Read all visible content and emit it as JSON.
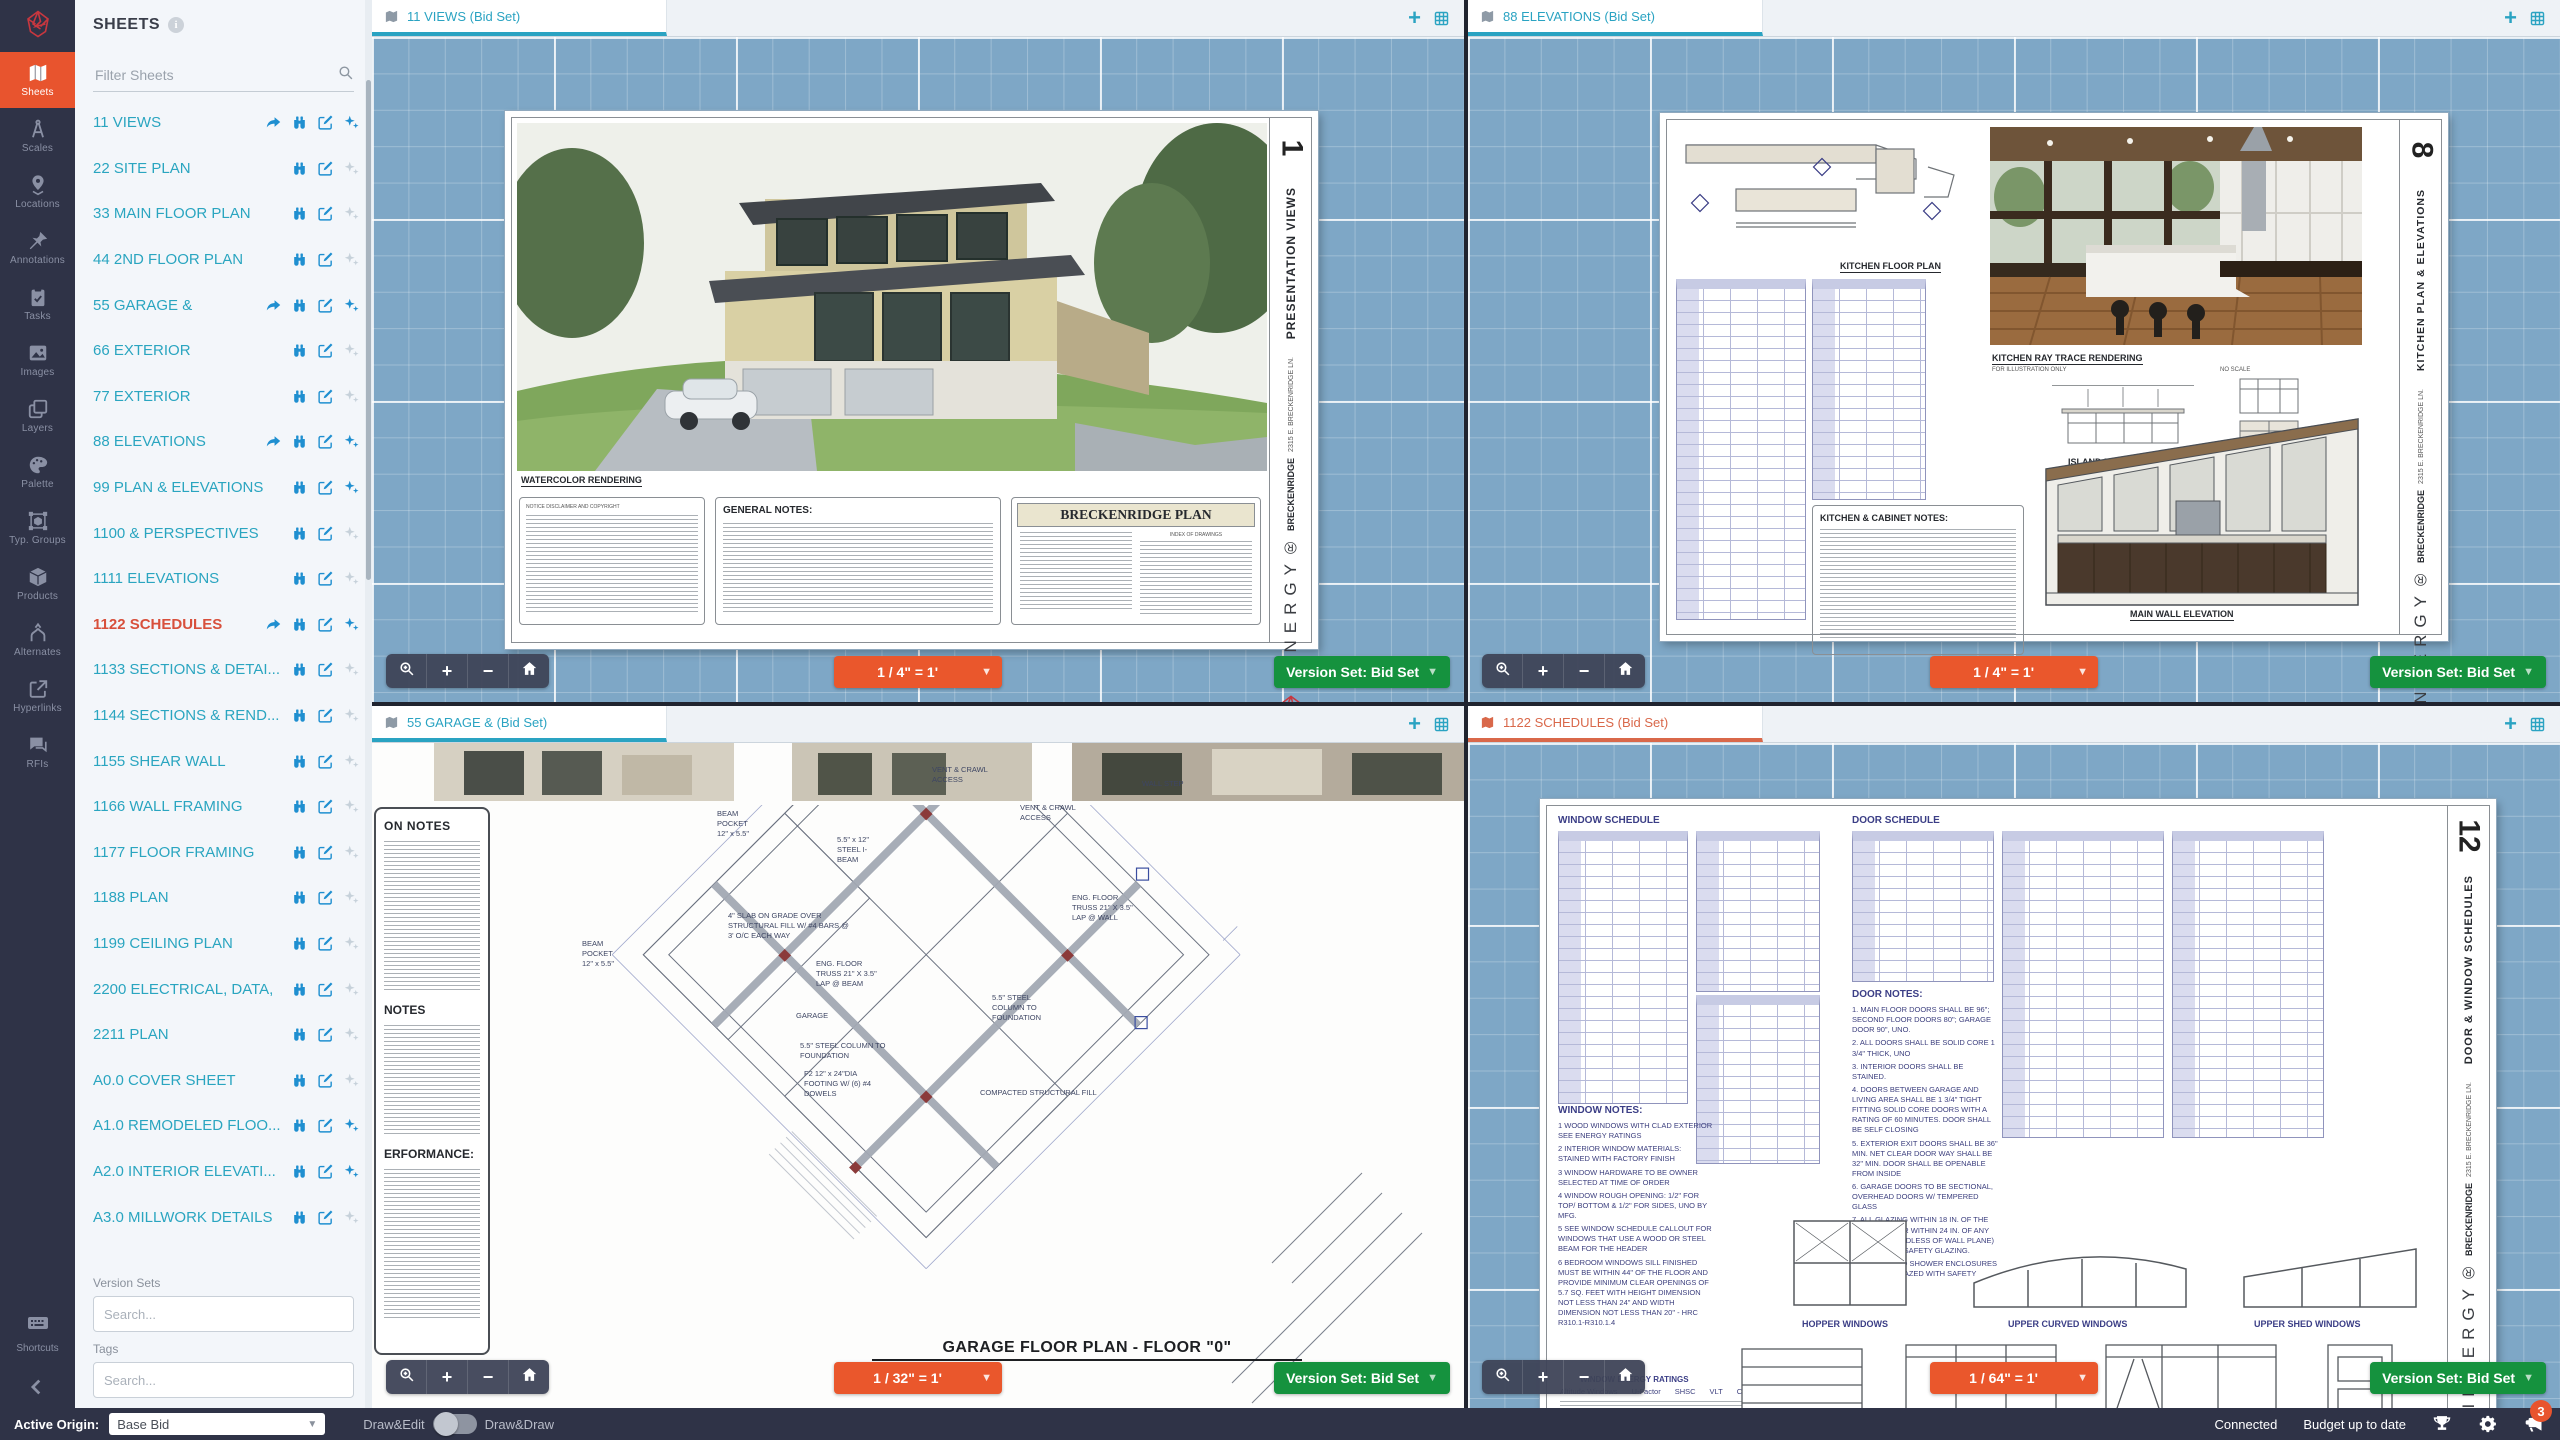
{
  "rail": {
    "items": [
      {
        "label": "Sheets",
        "icon": "map-icon",
        "active": true
      },
      {
        "label": "Scales",
        "icon": "compass-icon",
        "active": false
      },
      {
        "label": "Locations",
        "icon": "map-pin-icon",
        "active": false
      },
      {
        "label": "Annotations",
        "icon": "pushpin-icon",
        "active": false
      },
      {
        "label": "Tasks",
        "icon": "clipboard-icon",
        "active": false
      },
      {
        "label": "Images",
        "icon": "image-icon",
        "active": false
      },
      {
        "label": "Layers",
        "icon": "layers-icon",
        "active": false
      },
      {
        "label": "Palette",
        "icon": "palette-icon",
        "active": false
      },
      {
        "label": "Typ. Groups",
        "icon": "typ-groups-icon",
        "active": false
      },
      {
        "label": "Products",
        "icon": "products-icon",
        "active": false
      },
      {
        "label": "Alternates",
        "icon": "alternates-icon",
        "active": false
      },
      {
        "label": "Hyperlinks",
        "icon": "hyperlink-icon",
        "active": false
      },
      {
        "label": "RFIs",
        "icon": "rfi-icon",
        "active": false
      }
    ],
    "shortcuts_label": "Shortcuts"
  },
  "sheets_panel": {
    "title": "SHEETS",
    "filter_placeholder": "Filter Sheets",
    "items": [
      {
        "name": "11 VIEWS",
        "shared": true,
        "sparkle": true,
        "selected": false
      },
      {
        "name": "22 SITE PLAN",
        "shared": false,
        "sparkle": false,
        "selected": false
      },
      {
        "name": "33 MAIN FLOOR PLAN",
        "shared": false,
        "sparkle": false,
        "selected": false
      },
      {
        "name": "44 2ND FLOOR PLAN",
        "shared": false,
        "sparkle": false,
        "selected": false
      },
      {
        "name": "55 GARAGE &",
        "shared": true,
        "sparkle": true,
        "selected": false
      },
      {
        "name": "66 EXTERIOR",
        "shared": false,
        "sparkle": false,
        "selected": false
      },
      {
        "name": "77 EXTERIOR",
        "shared": false,
        "sparkle": false,
        "selected": false
      },
      {
        "name": "88 ELEVATIONS",
        "shared": true,
        "sparkle": true,
        "selected": false
      },
      {
        "name": "99 PLAN & ELEVATIONS",
        "shared": false,
        "sparkle": true,
        "selected": false
      },
      {
        "name": "1100 & PERSPECTIVES",
        "shared": false,
        "sparkle": false,
        "selected": false
      },
      {
        "name": "1111 ELEVATIONS",
        "shared": false,
        "sparkle": false,
        "selected": false
      },
      {
        "name": "1122 SCHEDULES",
        "shared": true,
        "sparkle": true,
        "selected": true
      },
      {
        "name": "1133 SECTIONS & DETAI...",
        "shared": false,
        "sparkle": false,
        "selected": false
      },
      {
        "name": "1144 SECTIONS & REND...",
        "shared": false,
        "sparkle": false,
        "selected": false
      },
      {
        "name": "1155 SHEAR WALL",
        "shared": false,
        "sparkle": false,
        "selected": false
      },
      {
        "name": "1166 WALL FRAMING",
        "shared": false,
        "sparkle": false,
        "selected": false
      },
      {
        "name": "1177 FLOOR FRAMING",
        "shared": false,
        "sparkle": false,
        "selected": false
      },
      {
        "name": "1188 PLAN",
        "shared": false,
        "sparkle": false,
        "selected": false
      },
      {
        "name": "1199 CEILING PLAN",
        "shared": false,
        "sparkle": false,
        "selected": false
      },
      {
        "name": "2200 ELECTRICAL, DATA,",
        "shared": false,
        "sparkle": false,
        "selected": false
      },
      {
        "name": "2211 PLAN",
        "shared": false,
        "sparkle": false,
        "selected": false
      },
      {
        "name": "A0.0 COVER SHEET",
        "shared": false,
        "sparkle": false,
        "selected": false
      },
      {
        "name": "A1.0 REMODELED FLOO...",
        "shared": false,
        "sparkle": true,
        "selected": false
      },
      {
        "name": "A2.0 INTERIOR ELEVATI...",
        "shared": false,
        "sparkle": true,
        "selected": false
      },
      {
        "name": "A3.0 MILLWORK DETAILS",
        "shared": false,
        "sparkle": false,
        "selected": false
      }
    ],
    "version_sets_label": "Version Sets",
    "version_sets_placeholder": "Search...",
    "tags_label": "Tags",
    "tags_placeholder": "Search..."
  },
  "viewports": [
    {
      "tab": "11 VIEWS (Bid Set)",
      "scale": "1 / 4\" = 1'",
      "version_set": "Version Set: Bid Set",
      "selected": false
    },
    {
      "tab": "88 ELEVATIONS (Bid Set)",
      "scale": "1 / 4\" = 1'",
      "version_set": "Version Set: Bid Set",
      "selected": false
    },
    {
      "tab": "55 GARAGE & (Bid Set)",
      "scale": "1 / 32\" = 1'",
      "version_set": "Version Set: Bid Set",
      "selected": false
    },
    {
      "tab": "1122 SCHEDULES (Bid Set)",
      "scale": "1 / 64\" = 1'",
      "version_set": "Version Set: Bid Set",
      "selected": true
    }
  ],
  "statusbar": {
    "active_origin_label": "Active Origin:",
    "active_origin_value": "Base Bid",
    "mode_left": "Draw&Edit",
    "mode_right": "Draw&Draw",
    "connection": "Connected",
    "budget": "Budget up to date",
    "notification_count": "3"
  },
  "sheets": {
    "sheet1": {
      "number": "1",
      "render_label": "WATERCOLOR RENDERING",
      "disclaimer": "NOTICE DISCLAIMER AND COPYRIGHT",
      "notes_title": "GENERAL NOTES:",
      "title_block": "BRECKENRIDGE PLAN",
      "index_label": "INDEX OF DRAWINGS",
      "side_title": "PRESENTATION VIEWS",
      "address": "2315 E. BRECKENRIDGE LN.",
      "project": "BRECKENRIDGE",
      "brand": "INNERGY®"
    },
    "sheet2": {
      "number": "8",
      "plan_label": "KITCHEN FLOOR PLAN",
      "render_label": "KITCHEN RAY TRACE RENDERING",
      "render_sub": "FOR ILLUSTRATION ONLY",
      "render_scale": "NO SCALE",
      "notes_title": "KITCHEN & CABINET NOTES:",
      "island_label": "ISLAND ELEVATION",
      "wall_label": "WALL ELEVATION",
      "main_wall_label": "MAIN WALL ELEVATION",
      "side_title": "KITCHEN PLAN & ELEVATIONS",
      "address": "2315 E. BRECKENRIDGE LN.",
      "project": "BRECKENRIDGE",
      "brand": "INNERGY®"
    },
    "sheet3": {
      "notes_heading_1": "ON NOTES",
      "notes_heading_2": "NOTES",
      "notes_heading_3": "ERFORMANCE:",
      "title": "GARAGE FLOOR PLAN - FLOOR \"0\"",
      "callouts": [
        {
          "x": 345,
          "y": 66,
          "t": "BEAM\nPOCKET\n12\" x 5.5\""
        },
        {
          "x": 210,
          "y": 196,
          "t": "BEAM\nPOCKET\n12\" x 5.5\""
        },
        {
          "x": 465,
          "y": 92,
          "t": "5.5\" x 12\"\nSTEEL I-\nBEAM"
        },
        {
          "x": 356,
          "y": 168,
          "t": "4\" SLAB ON GRADE OVER\nSTRUCTURAL FILL W/ #4 BARS @\n3' O/C EACH WAY"
        },
        {
          "x": 444,
          "y": 216,
          "t": "ENG. FLOOR\nTRUSS 21\" X 3.5\"\nLAP @ BEAM"
        },
        {
          "x": 428,
          "y": 298,
          "t": "5.5\" STEEL COLUMN TO\nFOUNDATION"
        },
        {
          "x": 432,
          "y": 326,
          "t": "F2 12\" x 24\"DIA\nFOOTING W/ (6) #4\nDOWELS"
        },
        {
          "x": 424,
          "y": 268,
          "t": "GARAGE"
        },
        {
          "x": 560,
          "y": 22,
          "t": "VENT & CRAWL\nACCESS"
        },
        {
          "x": 648,
          "y": 60,
          "t": "VENT & CRAWL\nACCESS"
        },
        {
          "x": 770,
          "y": 36,
          "t": "WALL STEP"
        },
        {
          "x": 700,
          "y": 150,
          "t": "ENG. FLOOR\nTRUSS 21\" X 3.5\"\nLAP @ WALL"
        },
        {
          "x": 620,
          "y": 250,
          "t": "5.5\" STEEL\nCOLUMN TO\nFOUNDATION"
        },
        {
          "x": 608,
          "y": 345,
          "t": "COMPACTED STRUCTURAL FILL"
        }
      ]
    },
    "sheet4": {
      "number": "12",
      "window_schedule_label": "WINDOW SCHEDULE",
      "door_schedule_label": "DOOR SCHEDULE",
      "door_notes_title": "DOOR NOTES:",
      "door_notes": [
        "1. MAIN FLOOR DOORS SHALL BE 96\"; SECOND FLOOR DOORS 80\"; GARAGE DOOR 90\", UNO.",
        "2. ALL DOORS SHALL BE SOLID CORE 1 3/4\" THICK, UNO",
        "3. INTERIOR DOORS SHALL BE STAINED.",
        "4. DOORS BETWEEN GARAGE AND LIVING AREA SHALL BE 1 3/4\" TIGHT FITTING SOLID CORE DOORS WITH A RATING OF 60 MINUTES. DOOR SHALL BE SELF CLOSING",
        "5. EXTERIOR EXIT DOORS SHALL BE 36\" MIN. NET CLEAR DOOR WAY SHALL BE 32\" MIN. DOOR SHALL BE OPENABLE FROM INSIDE",
        "6. GARAGE DOORS TO BE SECTIONAL, OVERHEAD DOORS W/ TEMPERED GLASS",
        "7. ALL GLAZING WITHIN 18 IN. OF THE FLOOR AND/OR WITHIN 24 IN. OF ANY DOOR (REGARDLESS OF WALL PLANE) ARE TO HAVE SAFETY GLAZING.",
        "8. ALL TUB AND SHOWER ENCLOSURES ARE TO BE GLAZED WITH SAFETY GLASS."
      ],
      "window_notes_title": "WINDOW NOTES:",
      "window_notes": [
        "1 WOOD WINDOWS WITH CLAD EXTERIOR SEE ENERGY RATINGS",
        "2 INTERIOR WINDOW MATERIALS: STAINED WITH FACTORY FINISH",
        "3 WINDOW HARDWARE TO BE OWNER SELECTED AT TIME OF ORDER",
        "4 WINDOW ROUGH OPENING: 1/2\" FOR TOP/ BOTTOM & 1/2\" FOR SIDES, UNO BY MFG.",
        "5 SEE WINDOW SCHEDULE CALLOUT FOR WINDOWS THAT USE A WOOD OR STEEL BEAM FOR THE HEADER",
        "6 BEDROOM WINDOWS SILL FINISHED MUST BE WITHIN 44\" OF THE FLOOR AND PROVIDE MINIMUM CLEAR OPENINGS OF 5.7 SQ. FEET WITH HEIGHT DIMENSION NOT LESS THAN 24\" AND WIDTH DIMENSION NOT LESS THAN 20\" - HRC R310.1-R310.1.4"
      ],
      "window_labels": [
        "HOPPER WINDOWS",
        "UPPER CURVED WINDOWS",
        "UPPER SHED WINDOWS"
      ],
      "door_labels": [
        "GARAGE DOOR",
        "CASCADE SLIDING DOOR",
        "ENTRY DOOR UNIT",
        "INTERIOR DOOR"
      ],
      "energy_title": "WINDOW ENERGY RATINGS",
      "energy_cols": [
        "Altitude Windows",
        "U-Factor",
        "SHSC",
        "VLT",
        "CR"
      ],
      "side_title": "DOOR & WINDOW SCHEDULES",
      "address": "2315 E. BRECKENRIDGE LN.",
      "project": "BRECKENRIDGE",
      "brand": "INNERGY®"
    }
  }
}
